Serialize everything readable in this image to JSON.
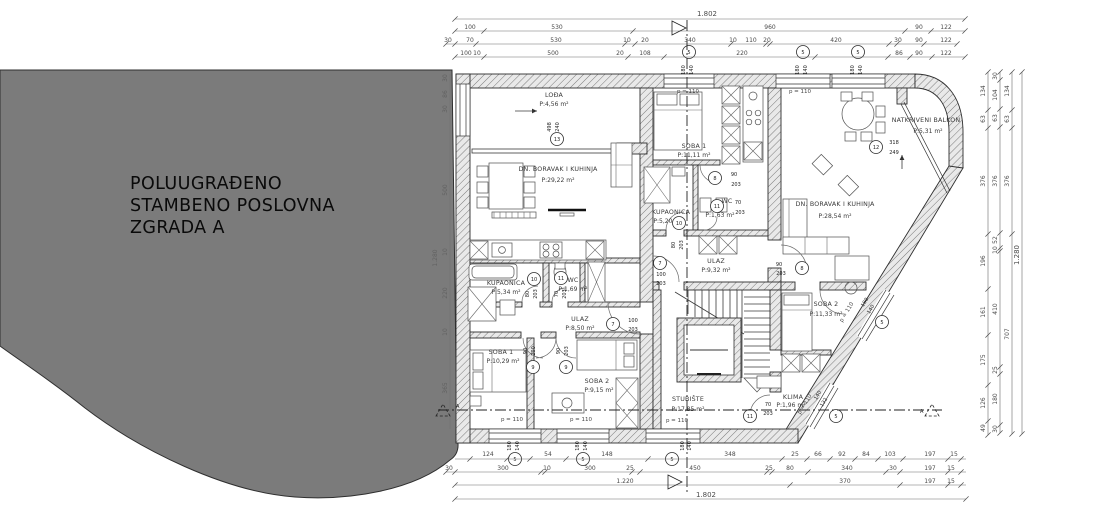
{
  "site": {
    "l1": "POLUUGRAĐENO",
    "l2": "STAMBENO POSLOVNA",
    "l3": "ZGRADA A"
  },
  "rooms": {
    "lodja": {
      "n": "LOĐA",
      "a": "P:4,56 m²"
    },
    "dnl": {
      "n": "DN. BORAVAK I KUHINJA",
      "a": "P:29,22 m²"
    },
    "kupl": {
      "n": "KUPAONICA",
      "a": "P:5,34 m²"
    },
    "wcl": {
      "n": "WC",
      "a": "P:1,69 m²"
    },
    "ull": {
      "n": "ULAZ",
      "a": "P:8,50 m²"
    },
    "s1l": {
      "n": "SOBA 1",
      "a": "P:10,29 m²"
    },
    "s2l": {
      "n": "SOBA 2",
      "a": "P:9,15 m²"
    },
    "s1m": {
      "n": "SOBA 1",
      "a": "P:11,11 m²"
    },
    "kupm": {
      "n": "KUPAONICA",
      "a": "P:5,20 m²"
    },
    "wcm": {
      "n": "WC",
      "a": "P:1,63 m²"
    },
    "ulm": {
      "n": "ULAZ",
      "a": "P:9,32 m²"
    },
    "stub": {
      "n": "STUBIŠTE",
      "a": "P:17,85 m²"
    },
    "klima": {
      "n": "KLIMA",
      "a": "P:1,96 m²"
    },
    "dnr": {
      "n": "DN. BORAVAK I KUHINJA",
      "a": "P:28,54 m²"
    },
    "balk": {
      "n": "NATKRIVENI BALKON",
      "a": "P:5,31 m²"
    },
    "s2r": {
      "n": "SOBA 2",
      "a": "P:11,33 m²"
    }
  },
  "dims": {
    "tA": "1.802",
    "t2": [
      "100",
      "530",
      "960",
      "90",
      "122"
    ],
    "t3": [
      "30",
      "70",
      "530",
      "10",
      "20",
      "340",
      "10",
      "110",
      "20",
      "420",
      "30",
      "90",
      "122"
    ],
    "t4": [
      "100",
      "10",
      "500",
      "20",
      "108",
      "220",
      "86",
      "90",
      "122"
    ],
    "b1": [
      "124",
      "54",
      "148",
      "348",
      "25",
      "66",
      "92",
      "84",
      "103",
      "197",
      "15"
    ],
    "b2": [
      "30",
      "300",
      "10",
      "300",
      "25",
      "450",
      "25",
      "80",
      "340",
      "30",
      "197",
      "15"
    ],
    "b3": [
      "1.220",
      "370",
      "197",
      "15"
    ],
    "bT": "1.802",
    "r1": [
      "134",
      "63",
      "376",
      "196",
      "161",
      "175",
      "126",
      "49"
    ],
    "r2": [
      "30",
      "104",
      "63",
      "376",
      "52",
      "10",
      "410",
      "25",
      "180",
      "30"
    ],
    "r3": [
      "134",
      "63",
      "376",
      "707"
    ],
    "rT": "1.280",
    "l1": [
      "30",
      "86",
      "30",
      "500",
      "10",
      "220",
      "10",
      "365"
    ],
    "lT": "1.280"
  },
  "marks": {
    "n5": "5",
    "n7": "7",
    "n8": "8",
    "n9": "9",
    "n10": "10",
    "n11": "11",
    "n12": "12",
    "n13": "13"
  },
  "vals": {
    "w180": "180",
    "w140": "140",
    "w498": "498",
    "w240": "240",
    "w318": "318",
    "w249": "249",
    "w132": "132",
    "h200": "200",
    "h203": "203",
    "d70": "70",
    "d80": "80",
    "d90": "90",
    "d100": "100",
    "para": "p = 110",
    "sec": "A"
  }
}
